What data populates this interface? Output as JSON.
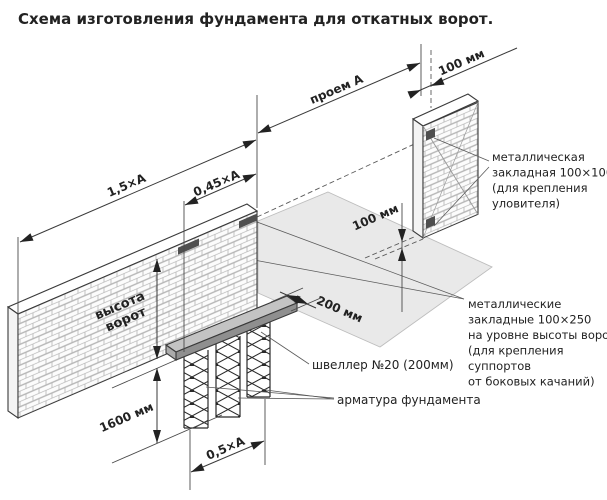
{
  "title": "Схема изготовления фундамента для откатных ворот.",
  "dims": {
    "len15": "1,5×А",
    "len045": "0,45×А",
    "len05": "0,5×А",
    "opening": "проем А",
    "gap100_top": "100 мм",
    "gap100_mid": "100 мм",
    "offset200": "200 мм",
    "depth1600": "1600 мм",
    "gate_height_1": "высота",
    "gate_height_2": "ворот"
  },
  "notes": {
    "catcher": [
      "металлическая",
      "закладная 100×100",
      "(для крепления",
      "уловителя)"
    ],
    "supports": [
      "металлические",
      "закладные 100×250",
      "на уровне высоты ворот",
      "(для крепления",
      "суппортов",
      "от боковых качаний)"
    ],
    "channel": "швеллер №20 (200мм)",
    "rebar": "арматура фундамента"
  },
  "colors": {
    "ground": "#e9e9e9",
    "beam_top": "#c3c3c3",
    "beam_front": "#8f8f8f",
    "beam_side": "#ababab",
    "plate": "#4f4f4f",
    "wall_face": "#fcfcfc"
  }
}
